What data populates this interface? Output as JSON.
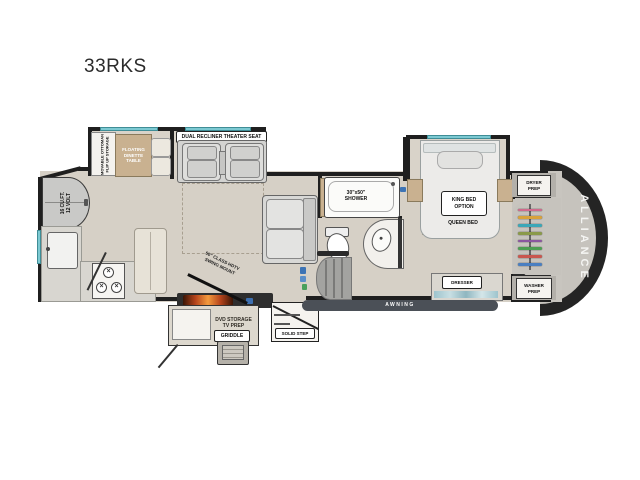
{
  "page": {
    "title": "33RKS"
  },
  "fp": {
    "ottoman": "MOVABLE OTTOMAN\nFLIP UP STORAGE",
    "dinette": "FLOATING\nDINETTE\nTABLE",
    "theater": "DUAL RECLINER THEATER SEAT",
    "fridge": "16 CU.FT.\n12 VOLT",
    "shower": "30\"x50\"\nSHOWER",
    "king": "KING BED\nOPTION",
    "queen": "QUEEN BED",
    "dresser": "DRESSER",
    "dryer": "DRYER\nPREP",
    "washer": "WASHER\nPREP",
    "brand": "ALLIANCE",
    "awning": "AWNING",
    "solid_step": "SOLID STEP",
    "griddle": "GRIDDLE",
    "tv": "50\" CLASS HDTV\nSWING MOUNT",
    "dvd": "DVD STORAGE\nTV PREP",
    "burner": "×",
    "hanger_colors": [
      "#d06a8c",
      "#d9a23a",
      "#3aa7b8",
      "#8a9a4a",
      "#8a56a0",
      "#4d9e53",
      "#c9574f",
      "#4a7fc1"
    ],
    "accent_colors": {
      "wall": "#1f1f1f",
      "window_glass": "#7cc9d2",
      "floor": "#d6d0c6",
      "awning_bar": "#4b5057",
      "flame": "#e06a2b",
      "wood": "#c9b190"
    }
  }
}
